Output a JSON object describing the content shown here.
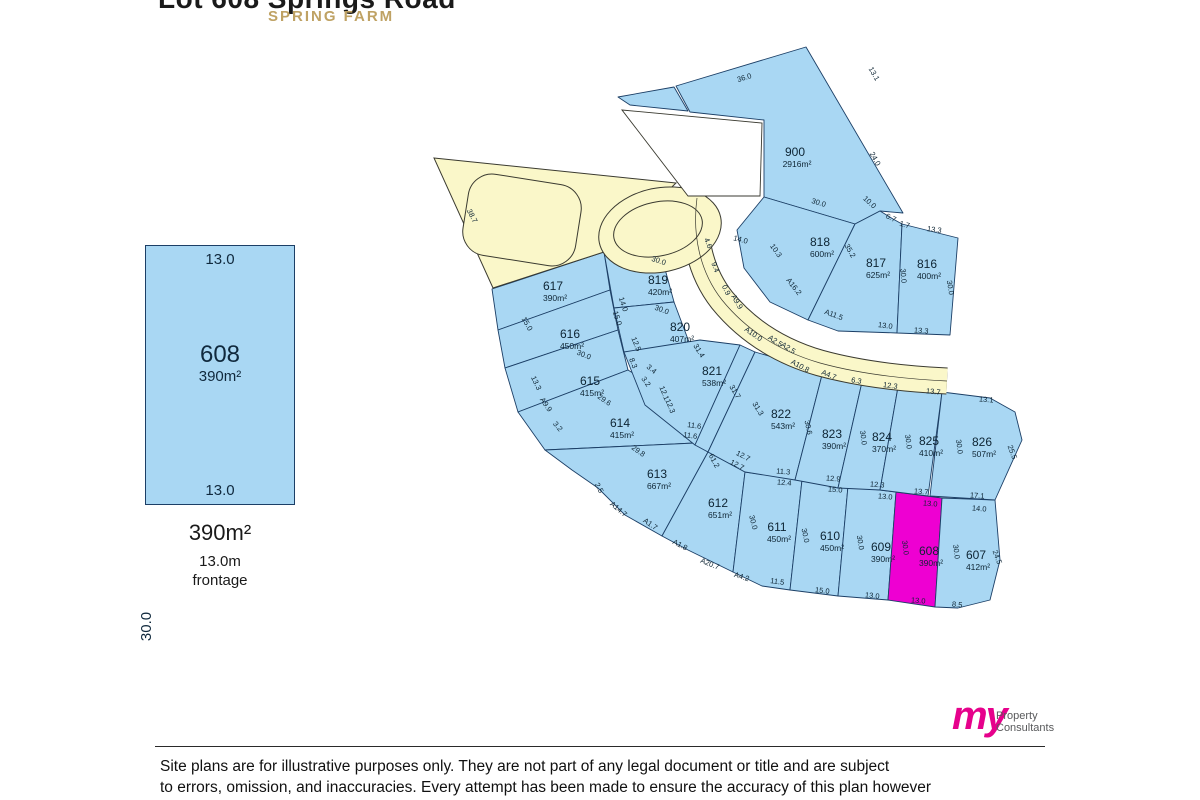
{
  "header": {
    "title": "Lot 608 Springs Road",
    "suburb": "SPRING FARM"
  },
  "inset": {
    "lot_number": "608",
    "lot_area": "390m²",
    "dim_top": "13.0",
    "dim_bottom": "13.0",
    "dim_left": "30.0",
    "summary_area": "390m²",
    "summary_frontage": "13.0m",
    "summary_frontage_label": "frontage"
  },
  "plan": {
    "colors": {
      "lot_fill": "#a9d7f3",
      "lot_stroke": "#1c3f66",
      "highlight_fill": "#ee00d2",
      "road_fill": "#faf7c9",
      "road_stroke": "#3a3a30",
      "label_color": "#0d2433",
      "notch_fill": "#ffffff"
    },
    "lots": [
      {
        "number": "900",
        "area": "2916m²",
        "lx": 795,
        "ly": 152,
        "points": "806,47 903,213 880,211 855,224 764,197 764,120 690,112 676,86"
      },
      {
        "number": "",
        "area": "",
        "lx": 0,
        "ly": 0,
        "points": "618,97 674,87 688,111 630,105"
      },
      {
        "number": "818",
        "area": "600m²",
        "lx": 820,
        "ly": 242,
        "points": "764,197 855,224 808,320 770,302 744,268 737,230"
      },
      {
        "number": "817",
        "area": "625m²",
        "lx": 876,
        "ly": 263,
        "points": "855,224 880,211 893,219 902,224 897,333 838,331 808,320"
      },
      {
        "number": "816",
        "area": "400m²",
        "lx": 927,
        "ly": 264,
        "points": "902,224 958,238 950,335 897,333"
      },
      {
        "number": "617",
        "area": "390m²",
        "lx": 553,
        "ly": 286,
        "points": "492,289 604,252 610,290 498,330"
      },
      {
        "number": "616",
        "area": "450m²",
        "lx": 570,
        "ly": 334,
        "points": "498,330 610,290 618,330 505,368"
      },
      {
        "number": "615",
        "area": "415m²",
        "lx": 590,
        "ly": 381,
        "points": "505,368 618,330 628,370 518,412"
      },
      {
        "number": "614",
        "area": "415m²",
        "lx": 620,
        "ly": 423,
        "points": "518,412 628,370 660,390 695,443 545,450"
      },
      {
        "number": "613",
        "area": "667m²",
        "lx": 657,
        "ly": 474,
        "points": "545,450 695,443 708,452 662,536 625,515 598,488 572,470"
      },
      {
        "number": "612",
        "area": "651m²",
        "lx": 718,
        "ly": 503,
        "points": "708,452 745,472 733,572 688,550 662,536"
      },
      {
        "number": "611",
        "area": "450m²",
        "lx": 777,
        "ly": 527,
        "points": "745,472 802,480 790,590 762,586 733,572"
      },
      {
        "number": "610",
        "area": "450m²",
        "lx": 830,
        "ly": 536,
        "points": "802,480 848,486 838,596 790,590"
      },
      {
        "number": "609",
        "area": "390m²",
        "lx": 881,
        "ly": 547,
        "points": "848,486 896,492 888,600 838,596"
      },
      {
        "number": "608",
        "area": "390m²",
        "lx": 929,
        "ly": 551,
        "highlight": true,
        "points": "896,492 942,498 935,607 888,600"
      },
      {
        "number": "607",
        "area": "412m²",
        "lx": 976,
        "ly": 555,
        "points": "942,498 995,500 1000,560 990,600 958,608 935,607"
      },
      {
        "number": "819",
        "area": "420m²",
        "lx": 658,
        "ly": 280,
        "points": "604,252 662,258 674,302 614,308"
      },
      {
        "number": "820",
        "area": "407m²",
        "lx": 680,
        "ly": 327,
        "points": "614,308 674,302 692,350 624,352"
      },
      {
        "number": "821",
        "area": "538m²",
        "lx": 712,
        "ly": 371,
        "points": "624,352 700,340 740,345 695,445 645,405"
      },
      {
        "number": "",
        "area": "",
        "lx": 0,
        "ly": 0,
        "points": "740,345 755,352 708,452 695,445"
      },
      {
        "number": "822",
        "area": "543m²",
        "lx": 781,
        "ly": 414,
        "points": "755,352 790,362 822,375 795,480 745,472 708,452"
      },
      {
        "number": "823",
        "area": "390m²",
        "lx": 832,
        "ly": 434,
        "points": "822,375 862,382 838,488 795,480"
      },
      {
        "number": "824",
        "area": "370m²",
        "lx": 882,
        "ly": 437,
        "points": "862,382 898,387 880,490 838,488"
      },
      {
        "number": "825",
        "area": "410m²",
        "lx": 929,
        "ly": 441,
        "points": "898,387 942,392 928,496 880,490"
      },
      {
        "number": "826",
        "area": "507m²",
        "lx": 982,
        "ly": 442,
        "points": "942,392 990,398 1015,412 1022,440 995,500 930,496"
      }
    ],
    "roads": {
      "triangle": "434,158 676,183 604,252 493,288",
      "notch": "622,110 762,123 760,196 688,196",
      "main_path": "M 697,198 C 692,235 700,272 722,300 C 748,332 782,352 820,363 C 860,374 905,379 947,381",
      "bulb": {
        "cx": 660,
        "cy": 230,
        "rx": 62,
        "ry": 42,
        "rot": -12
      },
      "island_bulb": {
        "cx": 658,
        "cy": 229,
        "rx": 45,
        "ry": 27,
        "rot": -12
      },
      "island_rect": {
        "x": 465,
        "y": 179,
        "w": 114,
        "h": 82,
        "rx": 24,
        "rot": 9
      }
    },
    "dimensions": [
      {
        "t": "36.0",
        "x": 745,
        "y": 80,
        "r": -17
      },
      {
        "t": "13.1",
        "x": 872,
        "y": 75,
        "r": 60
      },
      {
        "t": "24.0",
        "x": 873,
        "y": 160,
        "r": 60
      },
      {
        "t": "30.0",
        "x": 818,
        "y": 205,
        "r": 17
      },
      {
        "t": "10.0",
        "x": 868,
        "y": 204,
        "r": 42
      },
      {
        "t": "6.7",
        "x": 890,
        "y": 220,
        "r": 25
      },
      {
        "t": "1.7",
        "x": 904,
        "y": 227,
        "r": 15
      },
      {
        "t": "13.3",
        "x": 934,
        "y": 232,
        "r": 8
      },
      {
        "t": "35.2",
        "x": 848,
        "y": 252,
        "r": 60
      },
      {
        "t": "30.0",
        "x": 901,
        "y": 276,
        "r": 85
      },
      {
        "t": "30.0",
        "x": 948,
        "y": 288,
        "r": 80
      },
      {
        "t": "A16.2",
        "x": 792,
        "y": 288,
        "r": 52
      },
      {
        "t": "A11.5",
        "x": 833,
        "y": 317,
        "r": 20
      },
      {
        "t": "13.0",
        "x": 885,
        "y": 328,
        "r": 8
      },
      {
        "t": "13.3",
        "x": 921,
        "y": 333,
        "r": 5
      },
      {
        "t": "38.7",
        "x": 470,
        "y": 217,
        "r": 63
      },
      {
        "t": "4.6",
        "x": 706,
        "y": 244,
        "r": 68
      },
      {
        "t": "14.0",
        "x": 740,
        "y": 242,
        "r": 15
      },
      {
        "t": "10.3",
        "x": 774,
        "y": 252,
        "r": 55
      },
      {
        "t": "9.4",
        "x": 713,
        "y": 268,
        "r": 70
      },
      {
        "t": "0.9",
        "x": 724,
        "y": 291,
        "r": 65
      },
      {
        "t": "A9.9",
        "x": 735,
        "y": 303,
        "r": 60
      },
      {
        "t": "30.0",
        "x": 658,
        "y": 263,
        "r": 18
      },
      {
        "t": "30.0",
        "x": 661,
        "y": 312,
        "r": 20
      },
      {
        "t": "A10.0",
        "x": 752,
        "y": 336,
        "r": 35
      },
      {
        "t": "A2.5",
        "x": 774,
        "y": 343,
        "r": 33
      },
      {
        "t": "A2.5",
        "x": 787,
        "y": 350,
        "r": 33
      },
      {
        "t": "A10.8",
        "x": 799,
        "y": 368,
        "r": 28
      },
      {
        "t": "A4.7",
        "x": 828,
        "y": 377,
        "r": 22
      },
      {
        "t": "6.3",
        "x": 856,
        "y": 383,
        "r": 10
      },
      {
        "t": "12.3",
        "x": 890,
        "y": 388,
        "r": 8
      },
      {
        "t": "13.7",
        "x": 933,
        "y": 394,
        "r": 6
      },
      {
        "t": "13.1",
        "x": 986,
        "y": 402,
        "r": 5
      },
      {
        "t": "14.0",
        "x": 621,
        "y": 305,
        "r": 72
      },
      {
        "t": "15.0",
        "x": 615,
        "y": 319,
        "r": 72
      },
      {
        "t": "15.0",
        "x": 525,
        "y": 325,
        "r": 60
      },
      {
        "t": "30.0",
        "x": 583,
        "y": 357,
        "r": 22
      },
      {
        "t": "12.5",
        "x": 634,
        "y": 345,
        "r": 68
      },
      {
        "t": "8.3",
        "x": 631,
        "y": 364,
        "r": 68
      },
      {
        "t": "3.4",
        "x": 650,
        "y": 371,
        "r": 40
      },
      {
        "t": "3.2",
        "x": 644,
        "y": 383,
        "r": 55
      },
      {
        "t": "13.3",
        "x": 534,
        "y": 384,
        "r": 65
      },
      {
        "t": "A9.9",
        "x": 544,
        "y": 406,
        "r": 55
      },
      {
        "t": "3.2",
        "x": 556,
        "y": 428,
        "r": 50
      },
      {
        "t": "29.6",
        "x": 603,
        "y": 402,
        "r": 35
      },
      {
        "t": "29.8",
        "x": 637,
        "y": 453,
        "r": 35
      },
      {
        "t": "12.1",
        "x": 662,
        "y": 394,
        "r": 68
      },
      {
        "t": "12.3",
        "x": 668,
        "y": 407,
        "r": 68
      },
      {
        "t": "11.6",
        "x": 694,
        "y": 428,
        "r": 8
      },
      {
        "t": "11.6",
        "x": 690,
        "y": 438,
        "r": 8
      },
      {
        "t": "31.4",
        "x": 697,
        "y": 352,
        "r": 58
      },
      {
        "t": "31.7",
        "x": 733,
        "y": 393,
        "r": 58
      },
      {
        "t": "31.3",
        "x": 756,
        "y": 410,
        "r": 58
      },
      {
        "t": "30.6",
        "x": 806,
        "y": 428,
        "r": 78
      },
      {
        "t": "30.0",
        "x": 861,
        "y": 438,
        "r": 82
      },
      {
        "t": "30.0",
        "x": 906,
        "y": 442,
        "r": 82
      },
      {
        "t": "30.0",
        "x": 957,
        "y": 447,
        "r": 82
      },
      {
        "t": "25.5",
        "x": 1010,
        "y": 453,
        "r": 70
      },
      {
        "t": "12.7",
        "x": 742,
        "y": 458,
        "r": 28
      },
      {
        "t": "12.7",
        "x": 736,
        "y": 467,
        "r": 28
      },
      {
        "t": "61.2",
        "x": 712,
        "y": 462,
        "r": 62
      },
      {
        "t": "11.3",
        "x": 783,
        "y": 474,
        "r": 5
      },
      {
        "t": "12.4",
        "x": 784,
        "y": 485,
        "r": 5
      },
      {
        "t": "12.9",
        "x": 833,
        "y": 481,
        "r": 5
      },
      {
        "t": "15.0",
        "x": 835,
        "y": 492,
        "r": 5
      },
      {
        "t": "12.3",
        "x": 877,
        "y": 487,
        "r": 5
      },
      {
        "t": "13.0",
        "x": 885,
        "y": 499,
        "r": 5
      },
      {
        "t": "13.7",
        "x": 921,
        "y": 494,
        "r": 5
      },
      {
        "t": "13.0",
        "x": 930,
        "y": 506,
        "r": 5
      },
      {
        "t": "17.1",
        "x": 977,
        "y": 498,
        "r": 5
      },
      {
        "t": "14.0",
        "x": 979,
        "y": 511,
        "r": 5
      },
      {
        "t": "2.5",
        "x": 597,
        "y": 489,
        "r": 62
      },
      {
        "t": "A14.7",
        "x": 617,
        "y": 511,
        "r": 40
      },
      {
        "t": "A1.7",
        "x": 649,
        "y": 526,
        "r": 35
      },
      {
        "t": "A1.8",
        "x": 679,
        "y": 547,
        "r": 28
      },
      {
        "t": "A20.7",
        "x": 709,
        "y": 566,
        "r": 22
      },
      {
        "t": "A4.2",
        "x": 741,
        "y": 579,
        "r": 18
      },
      {
        "t": "30.0",
        "x": 751,
        "y": 523,
        "r": 75
      },
      {
        "t": "30.0",
        "x": 803,
        "y": 536,
        "r": 78
      },
      {
        "t": "30.0",
        "x": 858,
        "y": 543,
        "r": 80
      },
      {
        "t": "30.0",
        "x": 903,
        "y": 548,
        "r": 82
      },
      {
        "t": "30.0",
        "x": 954,
        "y": 552,
        "r": 82
      },
      {
        "t": "24.5",
        "x": 995,
        "y": 558,
        "r": 70
      },
      {
        "t": "11.5",
        "x": 777,
        "y": 584,
        "r": 8
      },
      {
        "t": "15.0",
        "x": 822,
        "y": 593,
        "r": 7
      },
      {
        "t": "13.0",
        "x": 872,
        "y": 598,
        "r": 6
      },
      {
        "t": "13.0",
        "x": 918,
        "y": 603,
        "r": 5
      },
      {
        "t": "8.5",
        "x": 957,
        "y": 607,
        "r": 5
      }
    ]
  },
  "footer": {
    "logo_my": "my",
    "logo_line1": "Property",
    "logo_line2": "Consultants",
    "disclaimer_line1": "Site plans are for illustrative purposes only. They are not part of any legal document or title and are subject",
    "disclaimer_line2": "to errors, omission, and inaccuracies. Every attempt has been made to ensure the accuracy of this plan however"
  }
}
